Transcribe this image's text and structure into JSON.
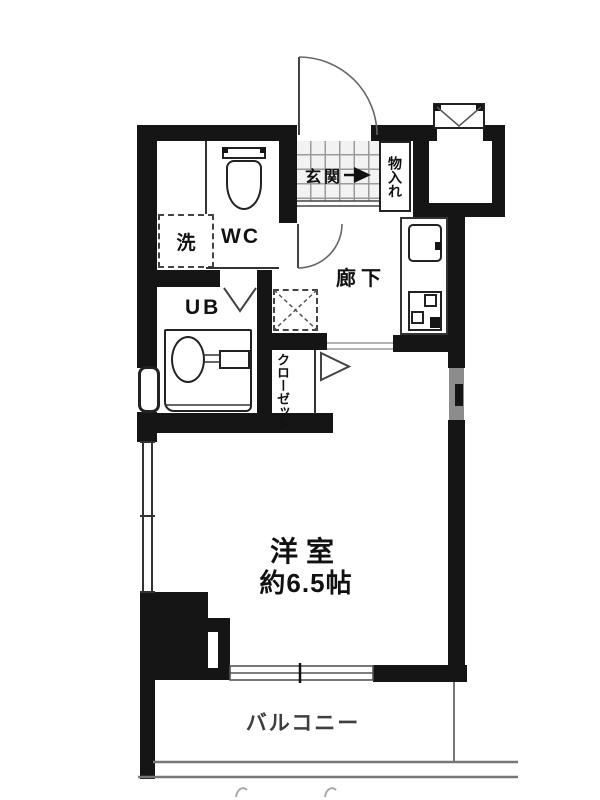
{
  "plan_type": "apartment-floor-plan",
  "rooms": {
    "genkan": {
      "label": "玄関"
    },
    "storage": {
      "label": "物入れ"
    },
    "wc": {
      "label": "WC"
    },
    "washer": {
      "label": "洗"
    },
    "bath": {
      "label": "UB"
    },
    "hallway": {
      "label": "廊下"
    },
    "closet": {
      "label": "クローゼット"
    },
    "main_room": {
      "label": "洋室",
      "size": "約6.5帖"
    },
    "balcony": {
      "label": "バルコニー"
    }
  },
  "colors": {
    "wall": "#151515",
    "line": "#333333",
    "thin": "#555555",
    "grid": "#9a9a9a",
    "graywin": "#8c8c8c",
    "textgray": "#3f3f3f",
    "faint": "#aaaaaa"
  }
}
